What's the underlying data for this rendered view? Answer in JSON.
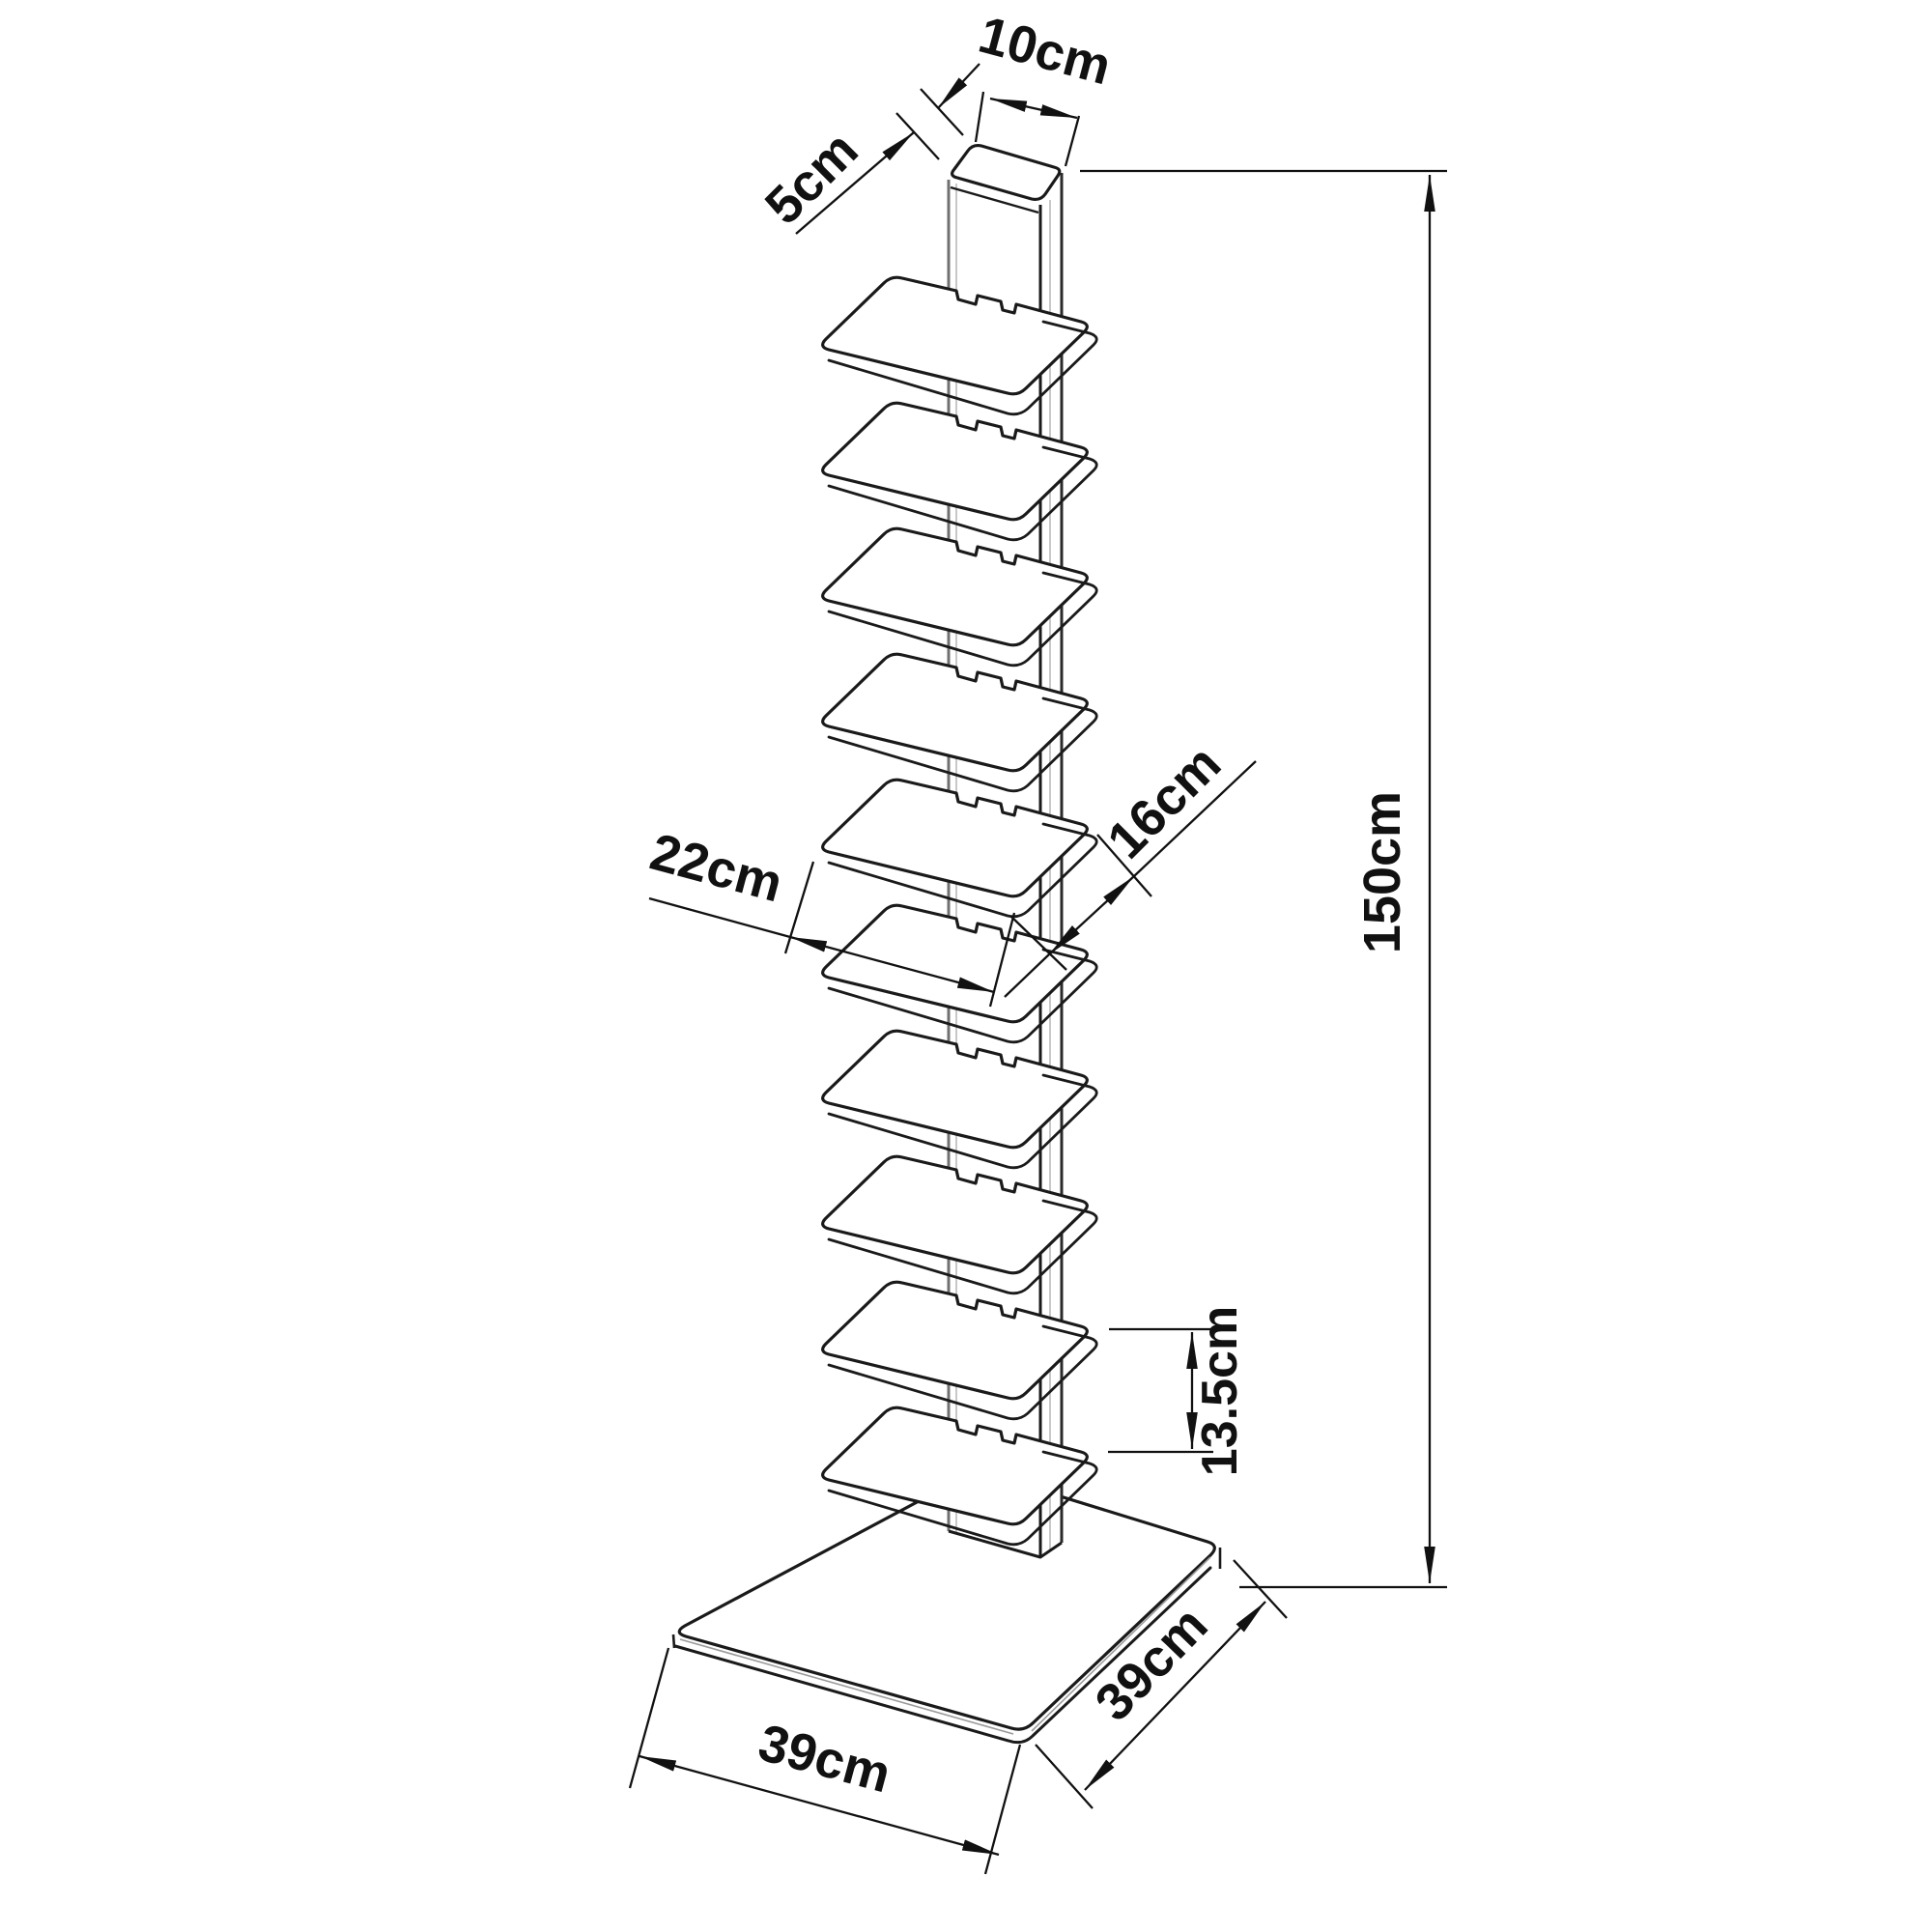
{
  "page": {
    "background": "#ffffff",
    "line_color": "#1a1a1a",
    "dimension_line_color": "#111111"
  },
  "figure": {
    "kind": "technical dimension drawing",
    "subject": "tower book shelf: vertical column with stacked shelves on square base",
    "shelf_count": 10
  },
  "labels": {
    "post_width": "10cm",
    "post_depth": "5cm",
    "total_height": "150cm",
    "shelf_depth": "16cm",
    "shelf_width": "22cm",
    "shelf_spacing": "13.5cm",
    "base_front": "39cm",
    "base_side": "39cm"
  }
}
